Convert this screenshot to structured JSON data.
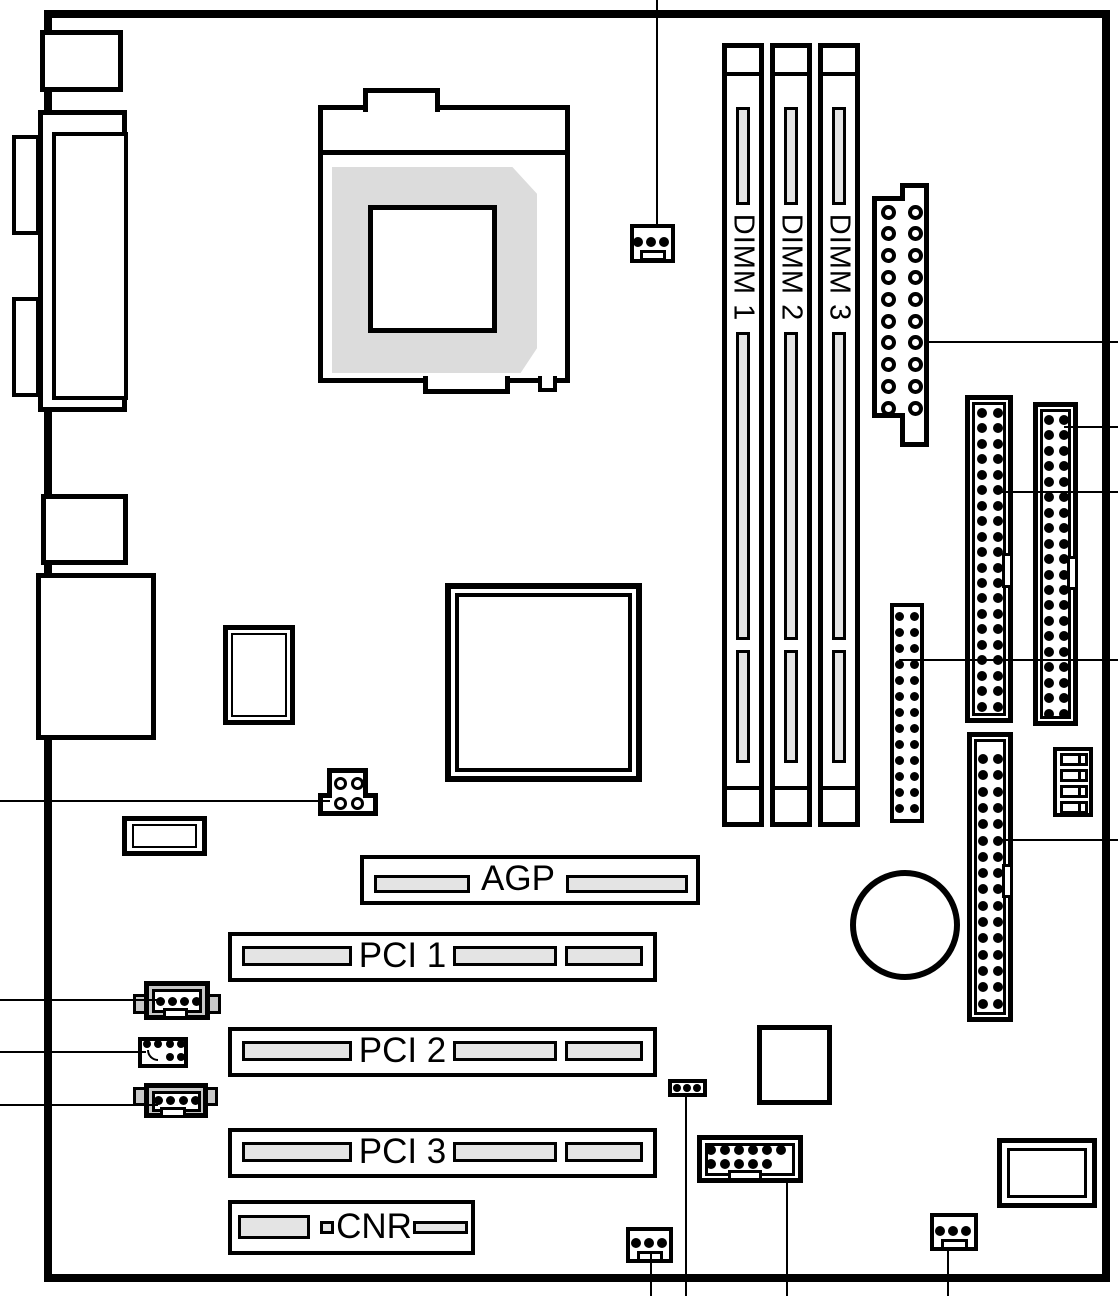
{
  "board": {
    "type": "motherboard-layout-diagram",
    "slots": {
      "dimm": {
        "labels": [
          "DIMM 1",
          "DIMM 2",
          "DIMM 3"
        ]
      },
      "agp": {
        "label": "AGP"
      },
      "pci": {
        "labels": [
          "PCI 1",
          "PCI 2",
          "PCI 3"
        ]
      },
      "cnr": {
        "label": "CNR"
      }
    },
    "colors": {
      "line": "#000000",
      "slot_fill": "#e4e4e4",
      "socket_fill": "#dcdcdc",
      "connector_fill": "#c8c8c8",
      "background": "#ffffff"
    }
  }
}
